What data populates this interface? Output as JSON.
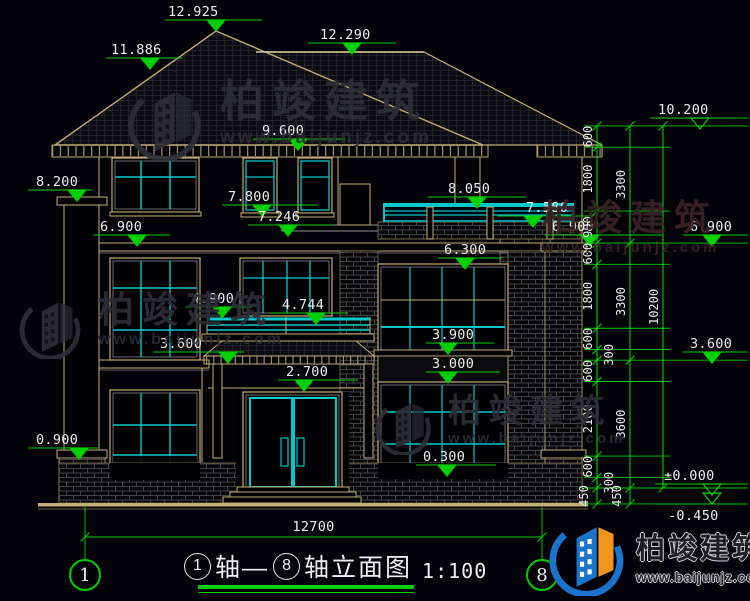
{
  "meta": {
    "drawing_type": "建筑立面图",
    "colors": {
      "background": "#020208",
      "dimension_green": "#00cf00",
      "line_tan": "#c2ae74",
      "detail_cyan": "#00c8cc",
      "text_white": "#ededed",
      "brand_blue": "#1b74cc",
      "brand_orange": "#f2951d",
      "watermark_gray": "#2e2e37",
      "watermark_maroon": "#3c2326"
    },
    "zero_y": 488,
    "px_per_m": 35.5
  },
  "watermark": {
    "brand": "柏竣建筑",
    "site": "www.baijunjz.com"
  },
  "logo": {
    "brand": "柏竣建筑",
    "site": "www.baijunjz.com"
  },
  "title": {
    "axis_a": "1",
    "seg_a": "轴—",
    "axis_b": "8",
    "seg_b": "轴立面图",
    "scale": "1:100"
  },
  "axis_bubbles": [
    {
      "label": "1",
      "cx": 85
    },
    {
      "label": "8",
      "cx": 542
    }
  ],
  "bottom_dim": {
    "label": "12700",
    "x1": 85,
    "x2": 542,
    "y": 537,
    "ext_top": 507,
    "ext_bottom": 560
  },
  "elevation_markers": [
    {
      "label": "12.925",
      "x1": 165,
      "x2": 262,
      "y": 20,
      "tip": 216,
      "tx": 168
    },
    {
      "label": "11.886",
      "x1": 106,
      "x2": 182,
      "y": 58,
      "tip": 150,
      "tx": 111
    },
    {
      "label": "12.290",
      "x1": 308,
      "x2": 396,
      "y": 43,
      "tip": 352,
      "tx": 320
    },
    {
      "label": "9.600",
      "x1": 253,
      "x2": 345,
      "y": 139,
      "tip": 298,
      "tx": 262
    },
    {
      "label": "8.200",
      "x1": 28,
      "x2": 92,
      "y": 190,
      "tip": 77,
      "tx": 36
    },
    {
      "label": "6.900",
      "x1": 93,
      "x2": 170,
      "y": 235,
      "tip": 137,
      "tx": 100
    },
    {
      "label": "7.800",
      "x1": 222,
      "x2": 318,
      "y": 205,
      "tip": 262,
      "tx": 228
    },
    {
      "label": "7.246",
      "x1": 248,
      "x2": 332,
      "y": 225,
      "tip": 288,
      "tx": 258
    },
    {
      "label": "4.900",
      "x1": 186,
      "x2": 252,
      "y": 307,
      "tip": 222,
      "tx": 192
    },
    {
      "label": "4.744",
      "x1": 270,
      "x2": 348,
      "y": 313,
      "tip": 316,
      "tx": 282
    },
    {
      "label": "3.600",
      "x1": 153,
      "x2": 244,
      "y": 352,
      "tip": 228,
      "tx": 160
    },
    {
      "label": "2.700",
      "x1": 278,
      "x2": 358,
      "y": 380,
      "tip": 304,
      "tx": 286
    },
    {
      "label": "0.900",
      "x1": 28,
      "x2": 98,
      "y": 448,
      "tip": 79,
      "tx": 36
    },
    {
      "label": "8.050",
      "x1": 428,
      "x2": 526,
      "y": 197,
      "tip": 477,
      "tx": 448
    },
    {
      "label": "7.580",
      "x1": 498,
      "x2": 594,
      "y": 216,
      "tip": 533,
      "tx": 526
    },
    {
      "label": "6.900",
      "x1": 545,
      "x2": 662,
      "y": 235,
      "tip": 590,
      "tx": 552
    },
    {
      "label": "6.900",
      "x1": 683,
      "x2": 748,
      "y": 235,
      "tip": 712,
      "tx": 690
    },
    {
      "label": "6.300",
      "x1": 438,
      "x2": 502,
      "y": 258,
      "tip": 465,
      "tx": 444
    },
    {
      "label": "3.900",
      "x1": 426,
      "x2": 494,
      "y": 343,
      "tip": 448,
      "tx": 432
    },
    {
      "label": "3.000",
      "x1": 426,
      "x2": 500,
      "y": 372,
      "tip": 448,
      "tx": 432
    },
    {
      "label": "0.300",
      "x1": 416,
      "x2": 496,
      "y": 465,
      "tip": 447,
      "tx": 423
    },
    {
      "label": "10.200",
      "x1": 650,
      "x2": 748,
      "y": 118,
      "tip": 700,
      "tx": 658,
      "open": true
    },
    {
      "label": "3.600",
      "x1": 683,
      "x2": 748,
      "y": 352,
      "tip": 712,
      "tx": 690
    },
    {
      "label": "±0.000",
      "x1": 655,
      "x2": 748,
      "y": 484,
      "tip": 712,
      "tx": 664,
      "open": true
    },
    {
      "label": "-0.450",
      "x1": 655,
      "x2": 748,
      "y": 504,
      "tip": 712,
      "tx": 668,
      "open": true,
      "below": true
    }
  ],
  "dim_chains": [
    {
      "x": 597,
      "breaks": [
        10.2,
        9.6,
        7.8,
        6.9,
        6.3,
        4.5,
        3.9,
        3.6,
        3.0,
        0.9,
        0.3,
        0,
        -0.45
      ],
      "labels": [
        "600",
        "1800",
        "900",
        "600",
        "1800",
        "600",
        "300",
        "600",
        "2100",
        "600",
        "300",
        "450"
      ],
      "dx": [
        -5,
        -5,
        -5,
        -5,
        -5,
        -5,
        16,
        -5,
        -5,
        -5,
        16,
        -9
      ]
    },
    {
      "x": 630,
      "breaks": [
        10.2,
        6.9,
        3.6,
        0,
        -0.45
      ],
      "labels": [
        "3300",
        "3300",
        "3600",
        "450"
      ],
      "dx": [
        -5,
        -5,
        -5,
        -9
      ]
    },
    {
      "x": 663,
      "breaks": [
        10.2,
        0
      ],
      "labels": [
        "10200"
      ],
      "dx": [
        -5
      ]
    }
  ],
  "ext_levels": {
    "minor": [
      9.6,
      7.8,
      6.3,
      4.5,
      3.9,
      3.0,
      0.9,
      0.3
    ],
    "major": [
      10.2,
      6.9,
      3.6,
      0,
      -0.45
    ]
  }
}
